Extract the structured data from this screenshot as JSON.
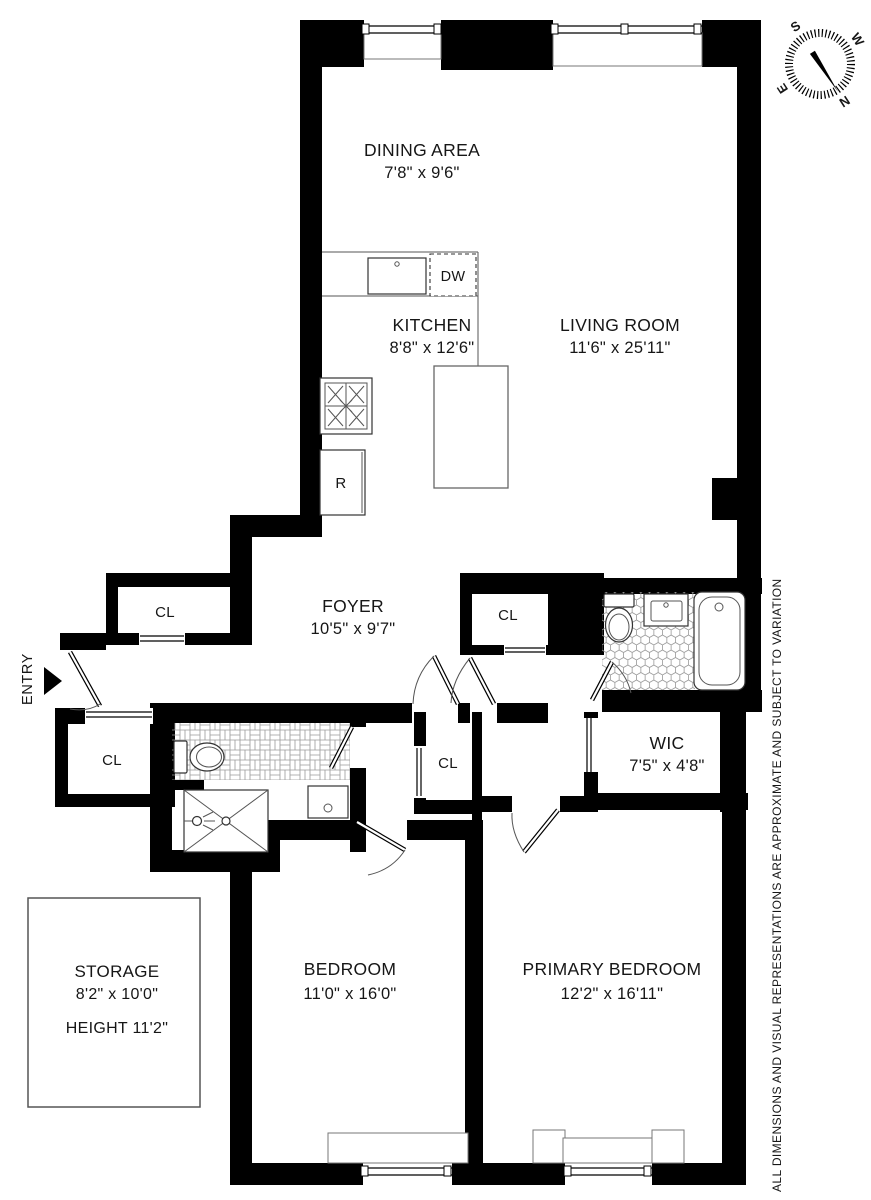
{
  "plan": {
    "rooms": {
      "dining": {
        "name": "DINING AREA",
        "dims": "7'8\" x 9'6\""
      },
      "kitchen": {
        "name": "KITCHEN",
        "dims": "8'8\" x 12'6\""
      },
      "living": {
        "name": "LIVING ROOM",
        "dims": "11'6\" x 25'11\""
      },
      "foyer": {
        "name": "FOYER",
        "dims": "10'5\" x 9'7\""
      },
      "wic": {
        "name": "WIC",
        "dims": "7'5\" x 4'8\""
      },
      "bedroom": {
        "name": "BEDROOM",
        "dims": "11'0\" x 16'0\""
      },
      "primary": {
        "name": "PRIMARY BEDROOM",
        "dims": "12'2\" x 16'11\""
      },
      "storage": {
        "name": "STORAGE",
        "dims": "8'2\" x 10'0\"",
        "height_note": "HEIGHT 11'2\""
      }
    },
    "closets": {
      "foyer_closet": "CL",
      "entry_closet": "CL",
      "hall_closet": "CL",
      "foyer_east_closet": "CL"
    },
    "appliances": {
      "dishwasher": "DW",
      "refrigerator": "R"
    },
    "entry": {
      "label": "ENTRY"
    },
    "compass": {
      "north": "N",
      "south": "S",
      "east": "E",
      "west": "W"
    },
    "disclaimer": "ALL DIMENSIONS AND VISUAL REPRESENTATIONS ARE APPROXIMATE AND SUBJECT TO VARIATION",
    "colors": {
      "wall": "#000000",
      "line": "#555555",
      "tile_stroke": "#999999"
    }
  }
}
